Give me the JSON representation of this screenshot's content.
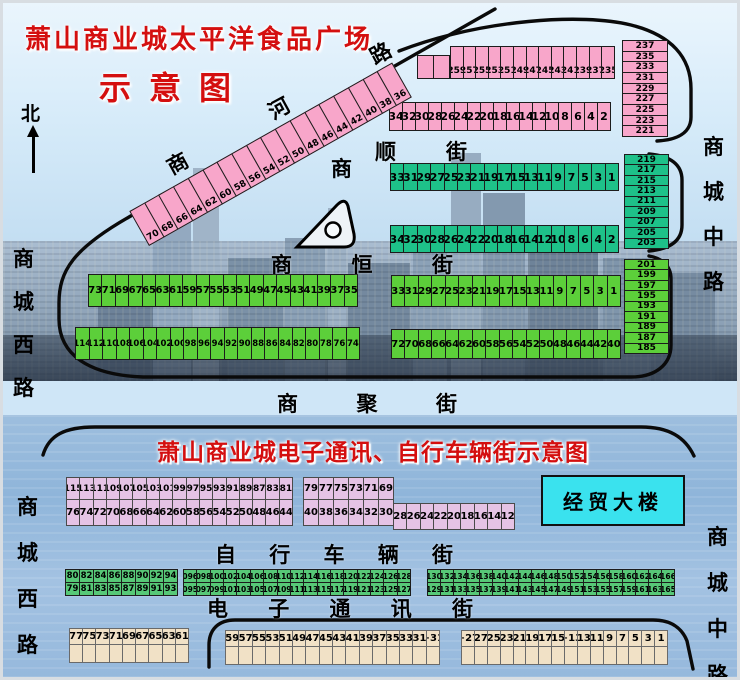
{
  "titles": {
    "main": "萧山商业城太平洋食品广场",
    "sub": "示意图",
    "bottom_section": "萧山商业城电子通讯、自行车辆街示意图"
  },
  "compass": {
    "north": "北"
  },
  "roads": {
    "west_top": "商城西路",
    "west_bottom": "商城西路",
    "center_top": "商城中路",
    "center_bottom": "商城中路",
    "river": "商河路",
    "shun_prefix": "商",
    "shun": "顺街",
    "heng": "商恒街",
    "ju": "商聚街",
    "bike": "自行车辆街",
    "elec": "电子通讯街"
  },
  "landmarks": {
    "jingmao": "经贸大楼"
  },
  "colors": {
    "pink": "#f8a6ca",
    "teal": "#1ec189",
    "green": "#5ccf3a",
    "purple": "#e5c3e5",
    "bike_green": "#57c877",
    "beige": "#f1e1c6",
    "cyan": "#3ae2ee",
    "title_red": "#d40f0f"
  },
  "blocks": {
    "pink_blank": [
      "",
      ""
    ],
    "pink_row_odd": [
      "259",
      "257",
      "255",
      "253",
      "251",
      "249",
      "247",
      "245",
      "243",
      "241",
      "239",
      "237",
      "235"
    ],
    "pink_col": [
      "237",
      "235",
      "233",
      "231",
      "229",
      "227",
      "225",
      "223",
      "221"
    ],
    "pink_row_even": [
      "34",
      "32",
      "30",
      "28",
      "26",
      "24",
      "22",
      "20",
      "18",
      "16",
      "14",
      "12",
      "10",
      "8",
      "6",
      "4",
      "2"
    ],
    "diag_strip": [
      "70",
      "68",
      "66",
      "64",
      "62",
      "60",
      "58",
      "56",
      "54",
      "52",
      "50",
      "48",
      "46",
      "44",
      "42",
      "40",
      "38",
      "36"
    ],
    "teal_row_odd": [
      "33",
      "31",
      "29",
      "27",
      "25",
      "23",
      "21",
      "19",
      "17",
      "15",
      "13",
      "11",
      "9",
      "7",
      "5",
      "3",
      "1"
    ],
    "teal_row_even": [
      "34",
      "32",
      "30",
      "28",
      "26",
      "24",
      "22",
      "20",
      "18",
      "16",
      "14",
      "12",
      "10",
      "8",
      "6",
      "4",
      "2"
    ],
    "teal_col": [
      "219",
      "217",
      "215",
      "213",
      "211",
      "209",
      "207",
      "205",
      "203"
    ],
    "green_left_odd": [
      "73",
      "71",
      "69",
      "67",
      "65",
      "63",
      "61",
      "59",
      "57",
      "55",
      "53",
      "51",
      "49",
      "47",
      "45",
      "43",
      "41",
      "39",
      "37",
      "35"
    ],
    "green_left_even": [
      "114",
      "112",
      "110",
      "108",
      "106",
      "104",
      "102",
      "100",
      "98",
      "96",
      "94",
      "92",
      "90",
      "88",
      "86",
      "84",
      "82",
      "80",
      "78",
      "76",
      "74"
    ],
    "green_right_odd": [
      "33",
      "31",
      "29",
      "27",
      "25",
      "23",
      "21",
      "19",
      "17",
      "15",
      "13",
      "11",
      "9",
      "7",
      "5",
      "3",
      "1"
    ],
    "green_right_even": [
      "72",
      "70",
      "68",
      "66",
      "64",
      "62",
      "60",
      "58",
      "56",
      "54",
      "52",
      "50",
      "48",
      "46",
      "44",
      "42",
      "40"
    ],
    "green_col": [
      "201",
      "199",
      "197",
      "195",
      "193",
      "191",
      "189",
      "187",
      "185"
    ],
    "purple_left_top": [
      "115",
      "113",
      "111",
      "109",
      "107",
      "105",
      "103",
      "101",
      "99",
      "97",
      "95",
      "93",
      "91",
      "89",
      "87",
      "83",
      "81"
    ],
    "purple_left_bottom": [
      "76",
      "74",
      "72",
      "70",
      "68",
      "66",
      "64",
      "62",
      "60",
      "58",
      "56",
      "54",
      "52",
      "50",
      "48",
      "46",
      "44"
    ],
    "purple_right_top": [
      "79",
      "77",
      "75",
      "73",
      "71",
      "69"
    ],
    "purple_right_bottom": [
      "40",
      "38",
      "36",
      "34",
      "32",
      "30"
    ],
    "purple_right_ext": [
      "28",
      "26",
      "24",
      "22",
      "20",
      "18",
      "16",
      "14",
      "12"
    ],
    "bike_left_top": [
      "80",
      "82",
      "84",
      "86",
      "88",
      "90",
      "92",
      "94"
    ],
    "bike_left_bottom": [
      "79",
      "81",
      "83",
      "85",
      "87",
      "89",
      "91",
      "93"
    ],
    "bike_mid_top": [
      "096",
      "098",
      "100",
      "102",
      "104",
      "106",
      "108",
      "110",
      "112",
      "114",
      "116",
      "118",
      "120",
      "122",
      "124",
      "126",
      "128"
    ],
    "bike_mid_bottom": [
      "095",
      "097",
      "099",
      "101",
      "103",
      "105",
      "107",
      "109",
      "111",
      "113",
      "115",
      "117",
      "119",
      "121",
      "123",
      "125",
      "127"
    ],
    "bike_right_top": [
      "130",
      "132",
      "134",
      "136",
      "138",
      "140",
      "142",
      "144",
      "146",
      "148",
      "150",
      "152",
      "154",
      "156",
      "158",
      "160",
      "162",
      "164",
      "166"
    ],
    "bike_right_bottom": [
      "129",
      "131",
      "133",
      "135",
      "137",
      "139",
      "141",
      "143",
      "145",
      "147",
      "149",
      "151",
      "153",
      "155",
      "157",
      "159",
      "161",
      "163",
      "165"
    ],
    "beige_left_top": [
      "77",
      "75",
      "73",
      "71",
      "69",
      "67",
      "65",
      "63",
      "61"
    ],
    "beige_left_blank": [
      "",
      "",
      "",
      "",
      "",
      "",
      "",
      "",
      ""
    ],
    "beige_mid_top": [
      "59",
      "57",
      "55",
      "53",
      "51",
      "49",
      "47",
      "45",
      "43",
      "41",
      "39",
      "37",
      "35",
      "33",
      "31",
      "+31"
    ],
    "beige_mid_blank": [
      "",
      "",
      "",
      "",
      "",
      "",
      "",
      "",
      "",
      "",
      "",
      "",
      "",
      "",
      "",
      ""
    ],
    "beige_right_top": [
      "+27",
      "27",
      "25",
      "23",
      "21",
      "19",
      "17",
      "15",
      "+13",
      "13",
      "11",
      "9",
      "7",
      "5",
      "3",
      "1"
    ],
    "beige_right_blank": [
      "",
      "",
      "",
      "",
      "",
      "",
      "",
      "",
      "",
      "",
      "",
      "",
      "",
      "",
      "",
      ""
    ]
  }
}
